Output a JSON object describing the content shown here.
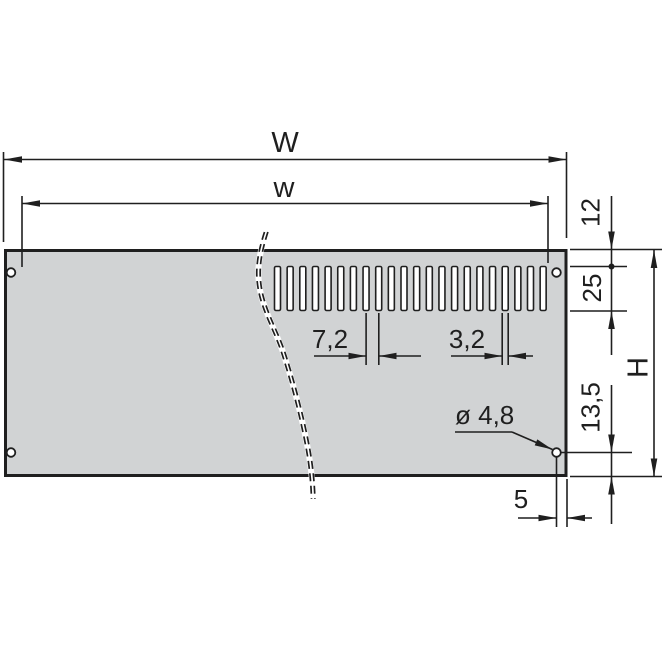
{
  "drawing": {
    "type": "technical-drawing",
    "title": "Vented front panel, dimensioned view",
    "colors": {
      "line": "#1f1f1f",
      "text": "#1f1f1f",
      "panel_fill": "#d1d3d4",
      "background": "#ffffff"
    },
    "labels": {
      "overall_width": "W",
      "inner_width": "w",
      "slot_top_offset": "12",
      "slot_height": "25",
      "overall_height": "H",
      "hole_bottom_offset": "13,5",
      "hole_edge_offset": "5",
      "slot_pitch": "7,2",
      "slot_width": "3,2",
      "hole_diameter": "ø 4,8"
    },
    "slots": {
      "count": 22
    },
    "holes": {
      "count": 4
    }
  }
}
